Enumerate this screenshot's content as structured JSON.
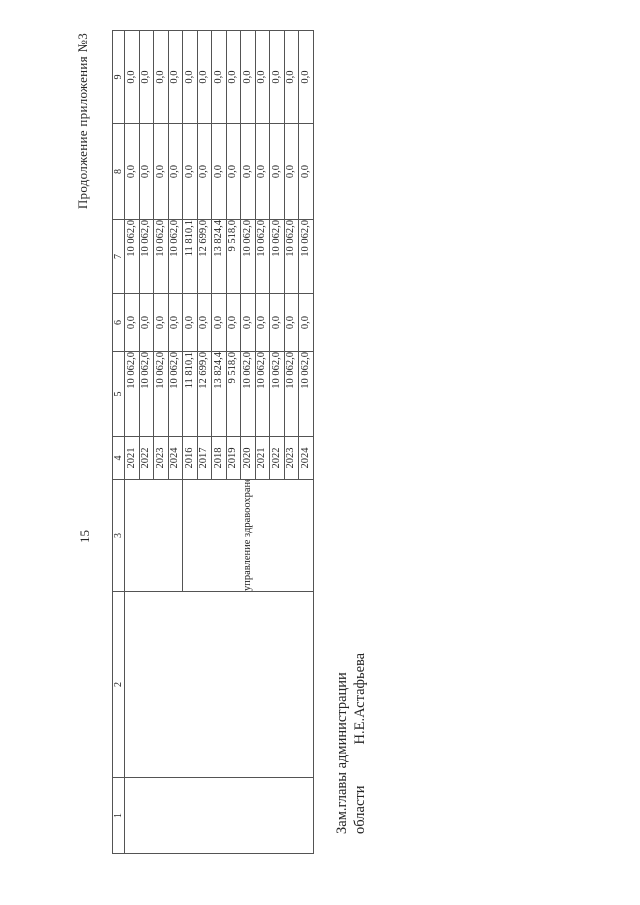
{
  "page": {
    "header_note": "Продолжение приложения №3",
    "page_number": "15"
  },
  "table": {
    "column_headers": [
      "1",
      "2",
      "3",
      "4",
      "5",
      "6",
      "7",
      "8",
      "9"
    ],
    "department_label": "управление здравоохранения области",
    "rows": [
      {
        "year": "2021",
        "c5": "10 062,0",
        "c6": "0,0",
        "c7": "10 062,0",
        "c8": "0,0",
        "c9": "0,0"
      },
      {
        "year": "2022",
        "c5": "10 062,0",
        "c6": "0,0",
        "c7": "10 062,0",
        "c8": "0,0",
        "c9": "0,0"
      },
      {
        "year": "2023",
        "c5": "10 062,0",
        "c6": "0,0",
        "c7": "10 062,0",
        "c8": "0,0",
        "c9": "0,0"
      },
      {
        "year": "2024",
        "c5": "10 062,0",
        "c6": "0,0",
        "c7": "10 062,0",
        "c8": "0,0",
        "c9": "0,0"
      },
      {
        "year": "2016",
        "c5": "11 810,1",
        "c6": "0,0",
        "c7": "11 810,1",
        "c8": "0,0",
        "c9": "0,0"
      },
      {
        "year": "2017",
        "c5": "12 699,0",
        "c6": "0,0",
        "c7": "12 699,0",
        "c8": "0,0",
        "c9": "0,0"
      },
      {
        "year": "2018",
        "c5": "13 824,4",
        "c6": "0,0",
        "c7": "13 824,4",
        "c8": "0,0",
        "c9": "0,0"
      },
      {
        "year": "2019",
        "c5": "9 518,0",
        "c6": "0,0",
        "c7": "9 518,0",
        "c8": "0,0",
        "c9": "0,0"
      },
      {
        "year": "2020",
        "c5": "10 062,0",
        "c6": "0,0",
        "c7": "10 062,0",
        "c8": "0,0",
        "c9": "0,0"
      },
      {
        "year": "2021",
        "c5": "10 062,0",
        "c6": "0,0",
        "c7": "10 062,0",
        "c8": "0,0",
        "c9": "0,0"
      },
      {
        "year": "2022",
        "c5": "10 062,0",
        "c6": "0,0",
        "c7": "10 062,0",
        "c8": "0,0",
        "c9": "0,0"
      },
      {
        "year": "2023",
        "c5": "10 062,0",
        "c6": "0,0",
        "c7": "10 062,0",
        "c8": "0,0",
        "c9": "0,0"
      },
      {
        "year": "2024",
        "c5": "10 062,0",
        "c6": "0,0",
        "c7": "10 062,0",
        "c8": "0,0",
        "c9": "0,0"
      }
    ]
  },
  "signature": {
    "line1": "Зам.главы администрации",
    "line2_left": "области",
    "line2_right": "Н.Е.Астафьева"
  }
}
